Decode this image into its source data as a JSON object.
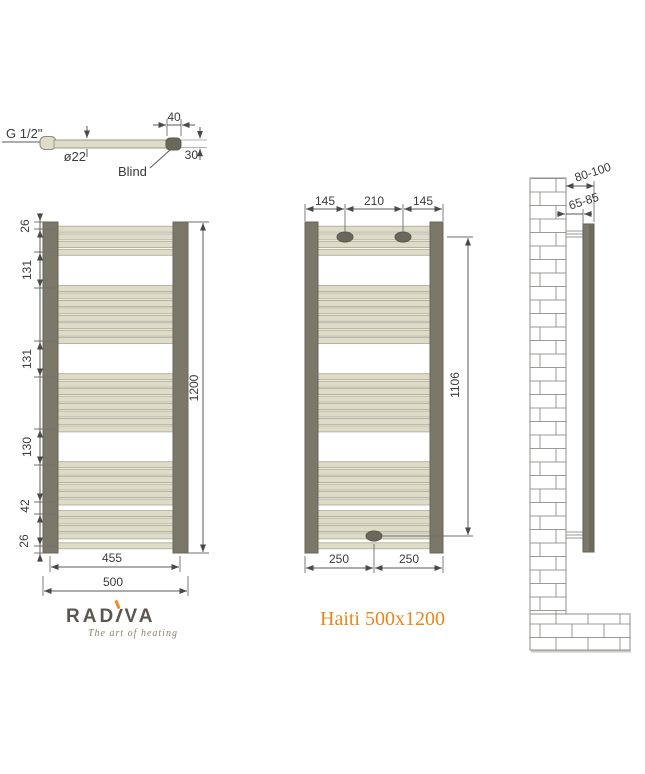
{
  "detail": {
    "thread_label": "G 1/2\"",
    "diameter_label": "ø22",
    "blind_label": "Blind",
    "cap_length_label": "40",
    "offset_label": "30"
  },
  "front_view": {
    "dims_left": [
      "26",
      "131",
      "131",
      "130",
      "42",
      "26"
    ],
    "dim_height": "1200",
    "dim_inner_width": "455",
    "dim_outer_width": "500"
  },
  "mount_view": {
    "dims_top": [
      "145",
      "210",
      "145"
    ],
    "dim_bracket_height": "1106",
    "dims_bottom": [
      "250",
      "250"
    ]
  },
  "side_view": {
    "dim_wall_outer": "80-100",
    "dim_wall_inner": "65-85"
  },
  "footer": {
    "brand_pre": "RAD",
    "brand_i": "I",
    "brand_post": "VA",
    "tagline": "The art of  heating",
    "product": "Haiti 500x1200"
  },
  "colors": {
    "tube": "#DEDCC7",
    "tube_stroke": "#ABA795",
    "rail": "#7C7869",
    "rail_stroke": "#69655A",
    "bracket": "#6B675B",
    "accent_orange": "#E8871C",
    "line": "#5a5a5a"
  },
  "radiator": {
    "height_mm": 1200,
    "width_mm": 500,
    "tube_centers_mm": [
      26,
      54,
      82,
      110,
      241,
      268,
      295,
      322,
      349,
      376,
      403,
      430,
      561,
      588,
      615,
      642,
      669,
      696,
      723,
      750,
      880,
      907,
      934,
      961,
      988,
      1015,
      1057,
      1084,
      1111,
      1138,
      1174
    ]
  }
}
